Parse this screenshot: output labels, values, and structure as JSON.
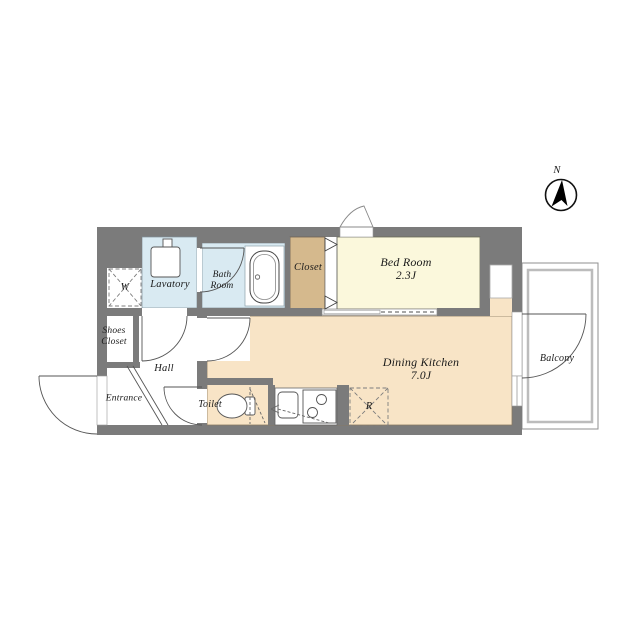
{
  "plan": {
    "compass_label": "N",
    "rooms": {
      "bed_room": {
        "name": "Bed Room",
        "size": "2.3J"
      },
      "dining_kitchen": {
        "name": "Dining Kitchen",
        "size": "7.0J"
      },
      "closet": "Closet",
      "lavatory": "Lavatory",
      "bath_room": "Bath\nRoom",
      "shoes_closet": "Shoes\nCloset",
      "hall": "Hall",
      "entrance": "Entrance",
      "toilet": "Toilet",
      "balcony": "Balcony",
      "washer_symbol": "W",
      "refrigerator_symbol": "R"
    },
    "colors": {
      "wall": "#7b7b7b",
      "bed_room": "#fbf8dc",
      "dining_kitchen": "#f8e4c6",
      "closet": "#d5b98d",
      "wet_area": "#d9eaf2",
      "floor_white": "#ffffff",
      "balcony_line": "#8f8f8f"
    }
  }
}
